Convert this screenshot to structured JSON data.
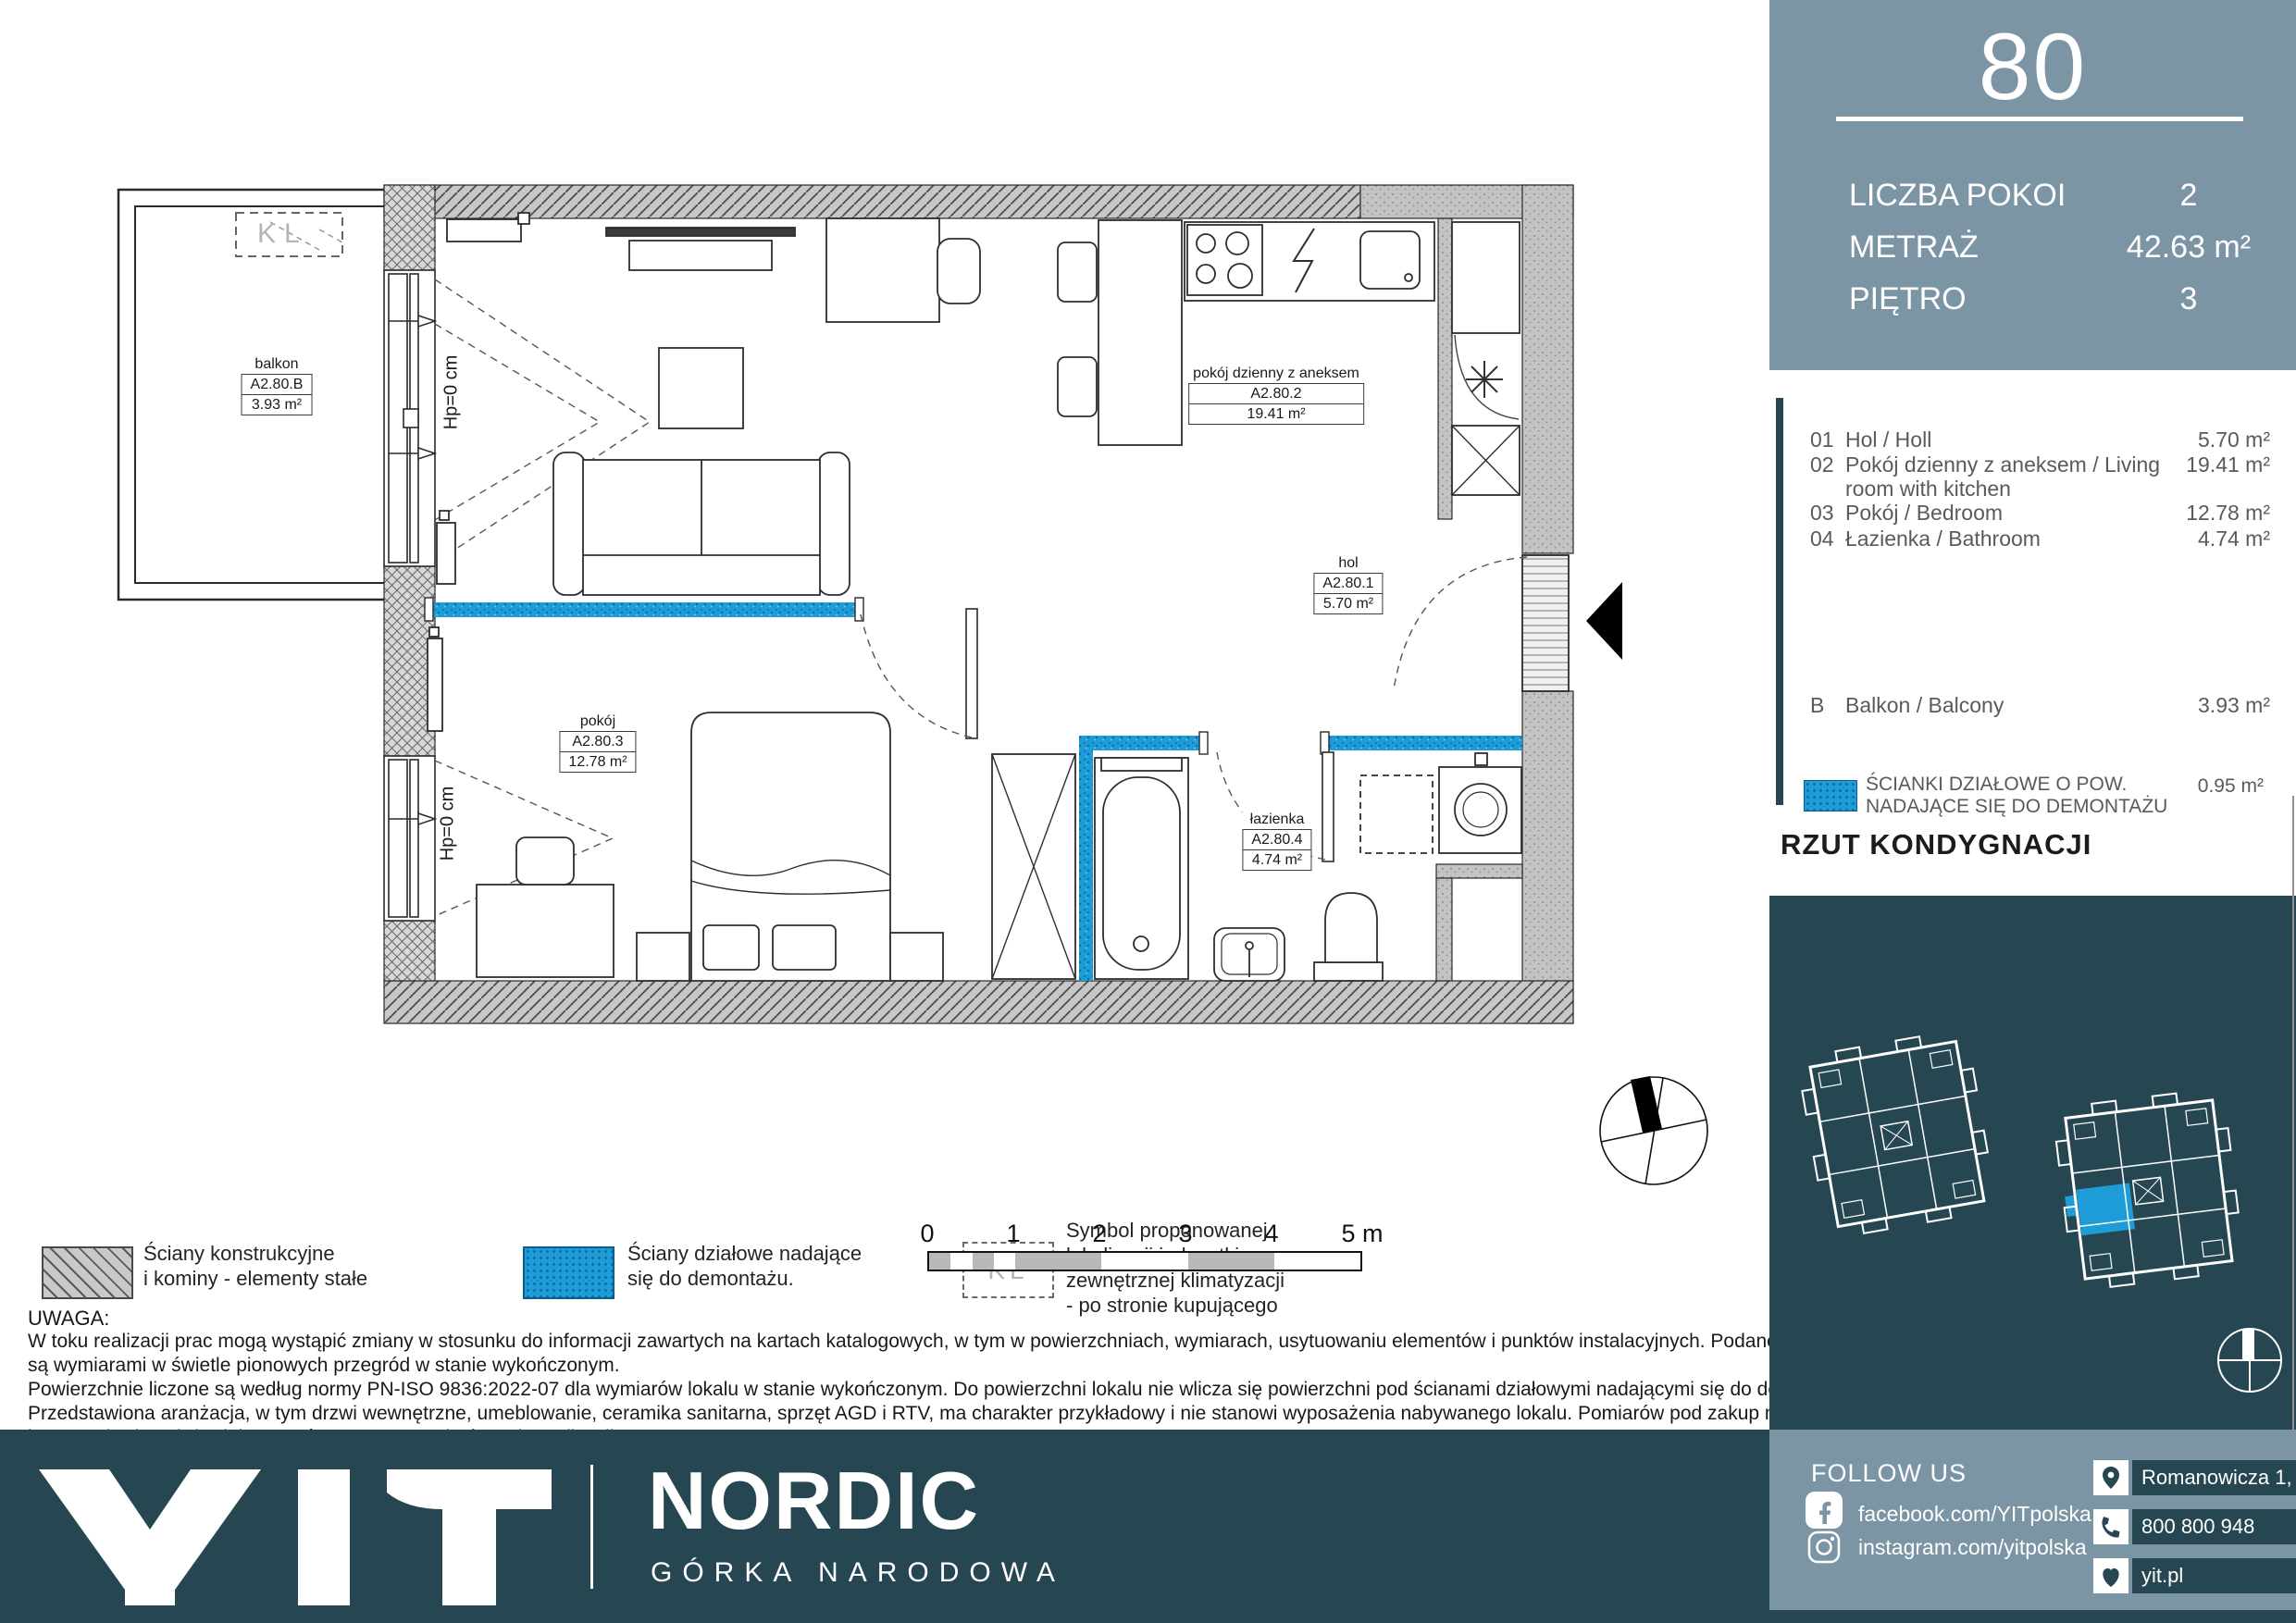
{
  "plan": {
    "labels": [
      {
        "name": "balkon",
        "code": "A2.80.B",
        "area": "3.93 m²"
      },
      {
        "name": "pokój dzienny z aneksem",
        "code": "A2.80.2",
        "area": "19.41 m²"
      },
      {
        "name": "hol",
        "code": "A2.80.1",
        "area": "5.70 m²"
      },
      {
        "name": "pokój",
        "code": "A2.80.3",
        "area": "12.78 m²"
      },
      {
        "name": "łazienka",
        "code": "A2.80.4",
        "area": "4.74 m²"
      }
    ],
    "hp": "Hp=0 cm",
    "kl": "KL"
  },
  "legend": {
    "items": [
      {
        "l1": "Ściany konstrukcyjne",
        "l2": "i kominy - elementy stałe"
      },
      {
        "l1": "Ściany działowe nadające",
        "l2": "się do demontażu."
      },
      {
        "l1": "Symbol proponowanej",
        "l2": "lokalizacji jednostki",
        "l3": "zewnętrznej klimatyzacji",
        "l4": "- po stronie kupującego"
      }
    ],
    "kl": "KL"
  },
  "scale": {
    "labels": [
      "0",
      "1",
      "2",
      "3",
      "4",
      "5 m"
    ]
  },
  "uwaga": {
    "title": "UWAGA:",
    "lines": [
      "W toku realizacji prac mogą wystąpić zmiany w stosunku do informacji zawartych na kartach katalogowych, w tym w powierzchniach, wymiarach, usytuowaniu elementów i punktów instalacyjnych. Podane wymiary",
      "są wymiarami w świetle pionowych przegród w stanie wykończonym.",
      "Powierzchnie liczone są według normy PN-ISO 9836:2022-07 dla wymiarów lokalu w stanie wykończonym. Do powierzchni lokalu nie wlicza się powierzchni pod ścianami działowymi nadającymi się do demontażu.",
      "Przedstawiona aranżacja, w tym drzwi wewnętrzne, umeblowanie, ceramika sanitarna, sprzęt AGD i RTV, ma charakter przykładowy i nie stanowi wyposażenia nabywanego lokalu. Pomiarów pod zakup mebli, urządzeń",
      "i wyposażenia należy dokonywać z natury, po zakończeniu realizacji."
    ]
  },
  "sidebar": {
    "unit": "80",
    "stats": [
      {
        "label": "LICZBA POKOI",
        "value": "2"
      },
      {
        "label": "METRAŻ",
        "value": "42.63 m²"
      },
      {
        "label": "PIĘTRO",
        "value": "3"
      }
    ],
    "rooms": [
      {
        "num": "01",
        "line1": "Hol / Holl",
        "line2": "",
        "area": "5.70 m²"
      },
      {
        "num": "02",
        "line1": "Pokój dzienny z aneksem / Living",
        "line2": "room with kitchen",
        "area": "19.41 m²"
      },
      {
        "num": "03",
        "line1": "Pokój / Bedroom",
        "line2": "",
        "area": "12.78 m²"
      },
      {
        "num": "04",
        "line1": "Łazienka / Bathroom",
        "line2": "",
        "area": "4.74 m²"
      }
    ],
    "balcony": {
      "num": "B",
      "name": "Balkon / Balcony",
      "area": "3.93 m²"
    },
    "partition": {
      "l1": "ŚCIANKI DZIAŁOWE O POW.",
      "l2": "NADAJĄCE SIĘ DO DEMONTAŻU",
      "area": "0.95 m²"
    },
    "title": "RZUT KONDYGNACJI"
  },
  "footer": {
    "logo": "YIT",
    "brand": "NORDIC",
    "sub": "GÓRKA NARODOWA",
    "follow": "FOLLOW US",
    "fb": "facebook.com/YITpolska",
    "ig": "instagram.com/yitpolska",
    "address": "Romanowicza 1, Kraków",
    "phone": "800 800 948",
    "site": "yit.pl"
  },
  "colors": {
    "accent": "#1E9CD8",
    "panel": "#7C95A4",
    "dark": "#264751"
  }
}
